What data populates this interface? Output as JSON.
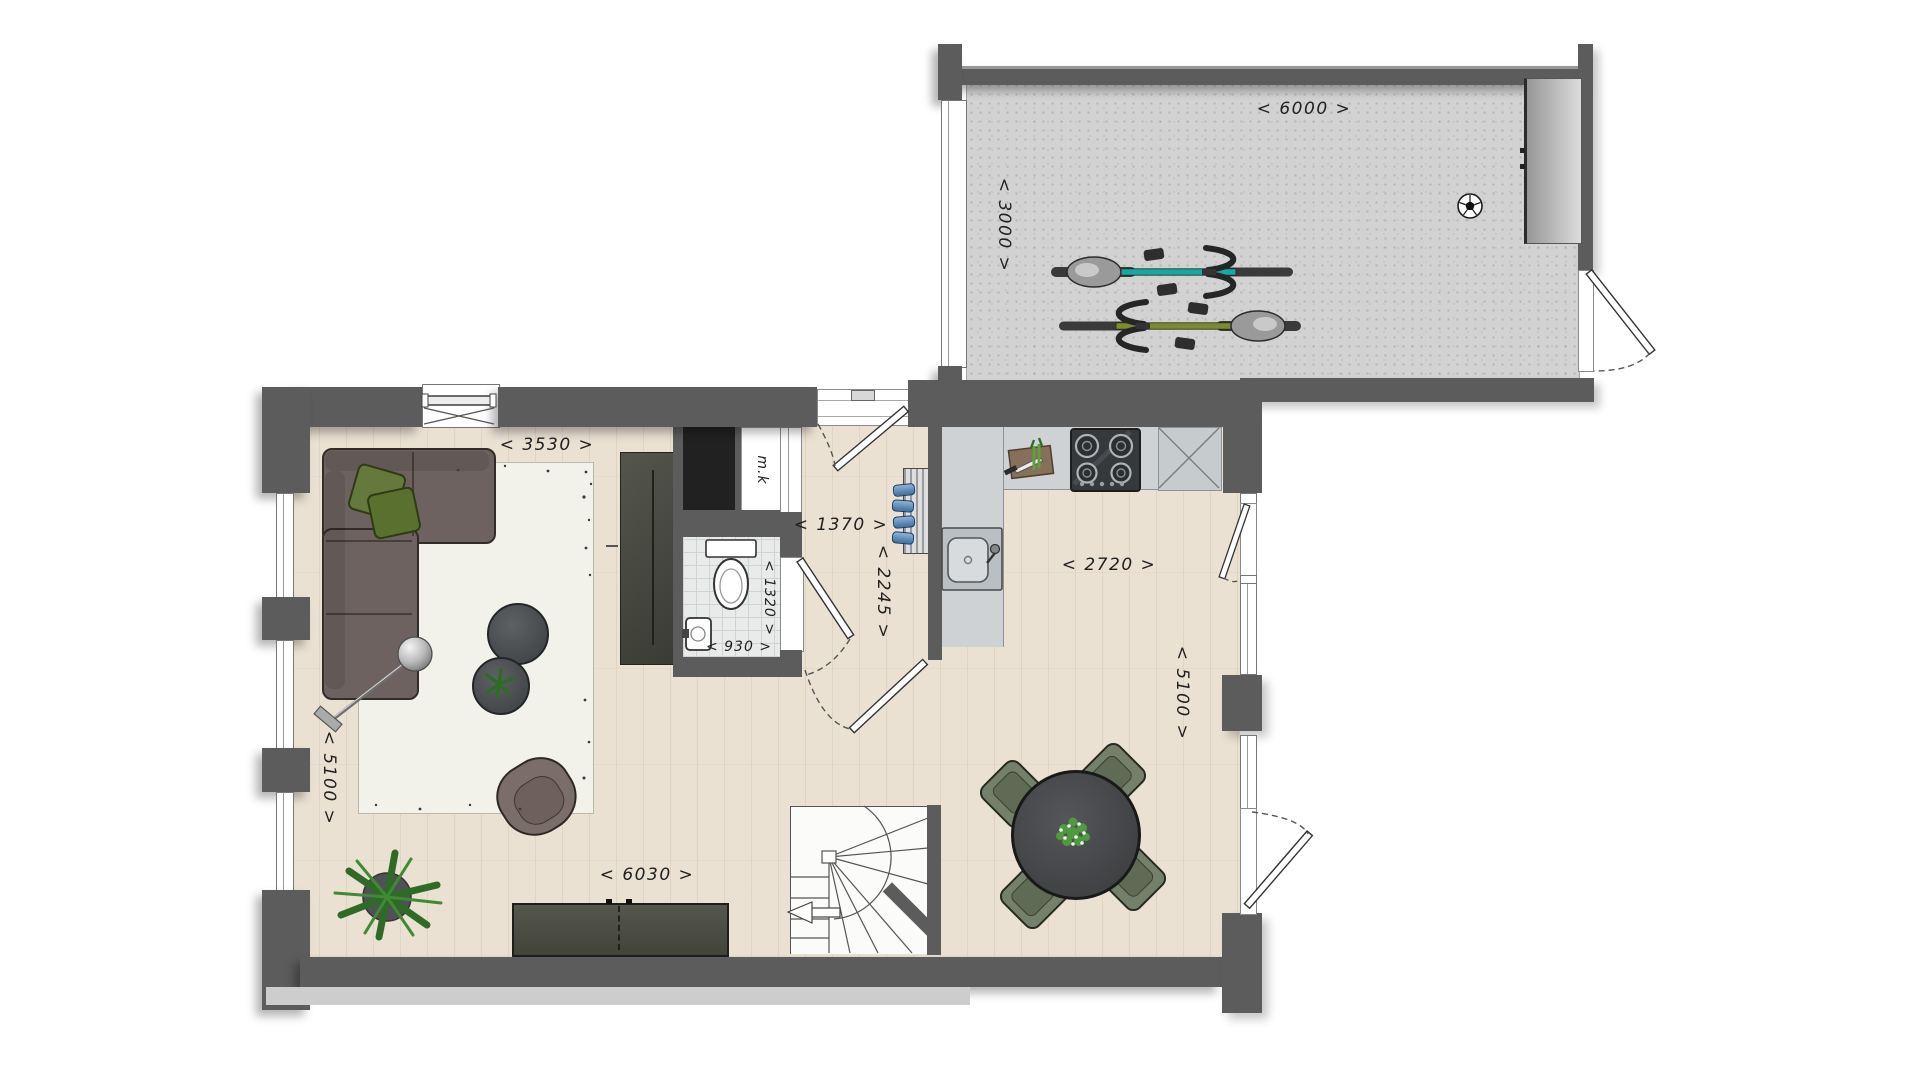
{
  "labels": {
    "garage_width": "< 6000 >",
    "garage_depth": "< 3000 >",
    "living_width": "< 3530 >",
    "living_depth": "< 5100 >",
    "living_length": "< 6030 >",
    "hall_width": "< 1370 >",
    "hall_depth": "< 2245 >",
    "toilet_depth": "< 1320 >",
    "toilet_width": "< 930 >",
    "kitchen_width": "< 2720 >",
    "kitchen_depth": "< 5100 >",
    "meter_cupboard": "m.k"
  },
  "colors": {
    "wall": "#5c5c5c",
    "garage_floor": "#d2d2d2",
    "wood_floor": "#eae1d3",
    "tile_floor": "#e9eaea",
    "rug": "#f2f1ea",
    "sofa": "#6e6260",
    "pillow_green": "#66793c",
    "dark_cabinet": "#4a4b41",
    "counter": "#ced2d4",
    "dining_chair": "#75806b",
    "bike_teal": "#18a7a2",
    "bike_olive": "#7c8c2c"
  },
  "objects": [
    "garage-with-two-bicycles-and-soccer-ball",
    "storage-cabinet",
    "corner-sofa",
    "green-pillows",
    "area-rug",
    "floor-lamp",
    "coffee-tables",
    "armchair",
    "potted-plant",
    "tv-sideboard",
    "winder-staircase",
    "wardrobe",
    "toilet",
    "corner-washbasin",
    "meter-cupboard",
    "coat-rack",
    "kitchen-counter",
    "kitchen-sink",
    "cooktop",
    "cutting-board",
    "dining-table",
    "dining-chairs",
    "table-plant"
  ]
}
